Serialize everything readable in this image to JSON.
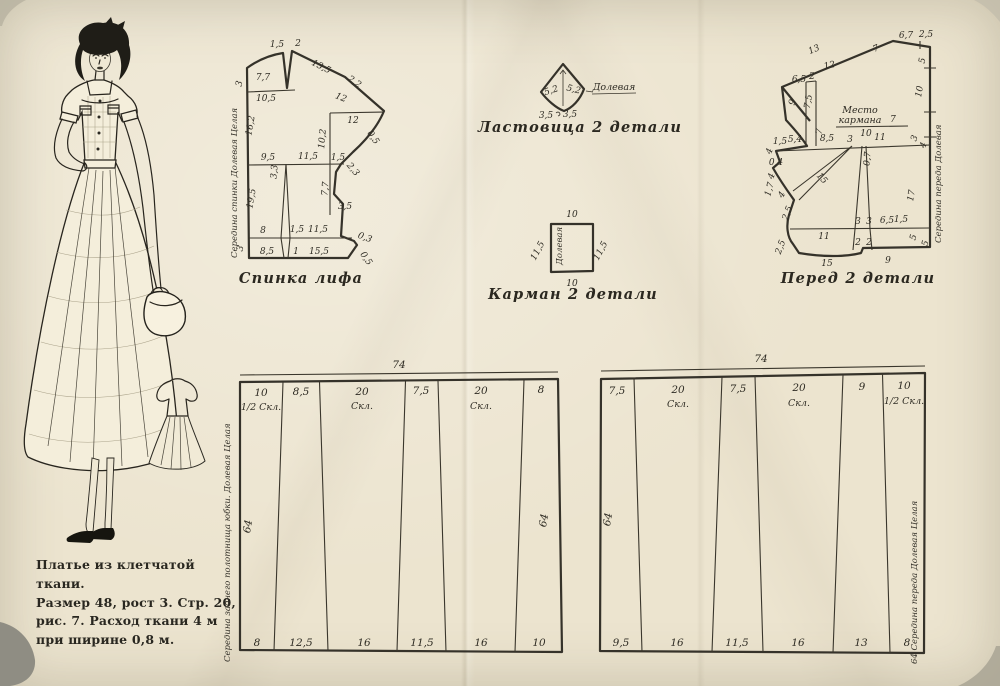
{
  "page": {
    "caption_lines": [
      "Платье из клетчатой ткани.",
      "Размер 48, рост 3. Стр. 20,",
      "рис. 7. Расход ткани 4 м",
      "при ширине 0,8 м."
    ]
  },
  "back_bodice": {
    "caption": "Спинка лифа",
    "grain_text": "Середина спинки Долевая Целая",
    "dims": [
      "1,5",
      "2",
      "7,7",
      "3",
      "13,5",
      "2,2",
      "10,5",
      "12",
      "12",
      "16,2",
      "10,2",
      "0,5",
      "9,5",
      "11,5",
      "1,5",
      "3,3",
      "2,3",
      "7,7",
      "3,5",
      "19,5",
      "8",
      "1,5",
      "11,5",
      "0,3",
      "3",
      "8,5",
      "1",
      "15,5",
      "0,5"
    ]
  },
  "gusset": {
    "caption": "Ластовица 2 детали",
    "grain_label": "Долевая",
    "dims": [
      "5,2",
      "5,2",
      "3,5",
      "3,5"
    ]
  },
  "pocket": {
    "caption": "Карман 2 детали",
    "grain_label": "Долевая",
    "dims": [
      "10",
      "11,5",
      "11,5",
      "10"
    ]
  },
  "front": {
    "caption": "Перед 2 детали",
    "pocket_place_line1": "Место",
    "pocket_place_line2": "кармана",
    "grain_text": "Середина переда Долевая",
    "dims": [
      "13",
      "7",
      "12",
      "6,5",
      "2",
      "9",
      "7,5",
      "6,7",
      "2,5",
      "5",
      "10",
      "7",
      "7",
      "10",
      "1,5",
      "5,4",
      "8,5",
      "3",
      "11",
      "3",
      "4",
      "4",
      "0,4",
      "4",
      "1,7",
      "4",
      "15",
      "0,7",
      "17",
      "2,5",
      "3",
      "3",
      "6,5",
      "1,5",
      "5",
      "11",
      "2",
      "2",
      "2,5",
      "15",
      "9",
      "5"
    ]
  },
  "skirt_back_panel": {
    "total_top": "74",
    "height_left": "64",
    "height_right": "64",
    "grain_text": "Середина заднего полотнища юбки. Долевая Целая",
    "top_widths": [
      "10",
      "8,5",
      "20",
      "7,5",
      "20",
      "8"
    ],
    "top_notes": [
      "1/2 Скл.",
      "",
      "Скл.",
      "",
      "Скл.",
      ""
    ],
    "bottom_widths": [
      "8",
      "12,5",
      "16",
      "11,5",
      "16",
      "10"
    ]
  },
  "skirt_front_panel": {
    "total_top": "74",
    "height_left": "64",
    "grain_text": "64 Середина переда Долевая Целая",
    "top_widths": [
      "7,5",
      "20",
      "7,5",
      "20",
      "9",
      "10"
    ],
    "top_notes": [
      "",
      "Скл.",
      "",
      "Скл.",
      "",
      "1/2 Скл."
    ],
    "bottom_widths": [
      "9,5",
      "16",
      "11,5",
      "16",
      "13",
      "8"
    ]
  }
}
